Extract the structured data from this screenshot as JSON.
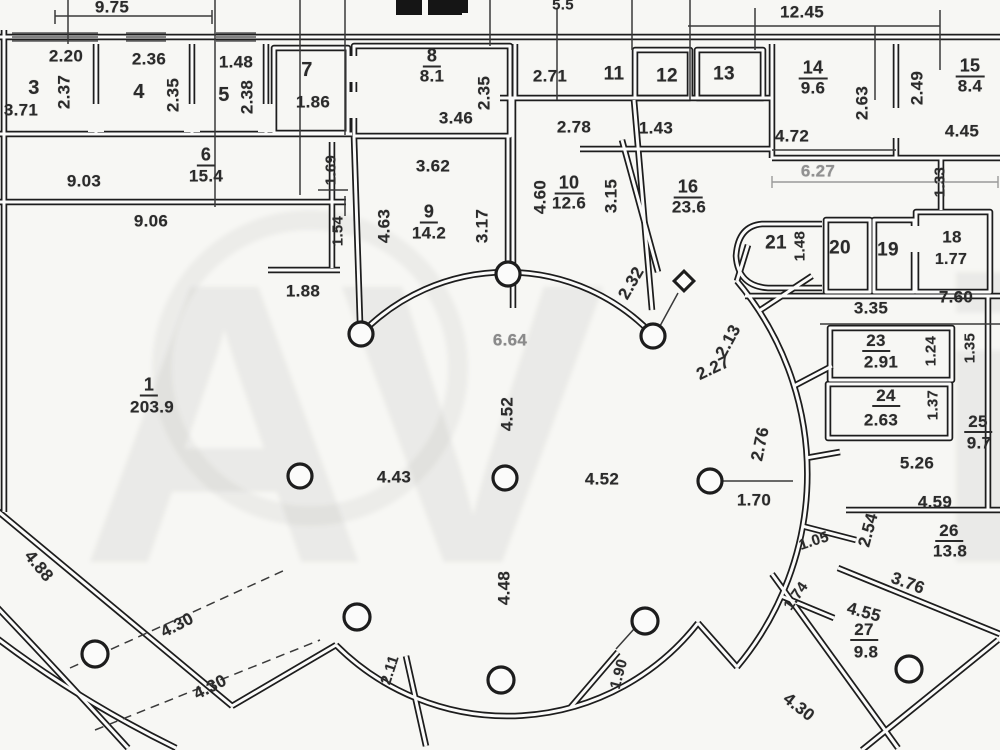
{
  "page": {
    "bg": "#f7f7f4",
    "ink": "#2b2b2b",
    "faded_ink": "#8d8d8d",
    "kind": "scanned floor plan"
  },
  "watermark": {
    "main": "AV",
    "tail": "i"
  },
  "rooms": [
    {
      "number": "1",
      "area": "203.9"
    },
    {
      "number": "3"
    },
    {
      "number": "4"
    },
    {
      "number": "5"
    },
    {
      "number": "6",
      "area": "15.4"
    },
    {
      "number": "7"
    },
    {
      "number": "8",
      "area": "8.1"
    },
    {
      "number": "9",
      "area": "14.2"
    },
    {
      "number": "10",
      "area": "12.6"
    },
    {
      "number": "11"
    },
    {
      "number": "12"
    },
    {
      "number": "13"
    },
    {
      "number": "14",
      "area": "9.6"
    },
    {
      "number": "15",
      "area": "8.4"
    },
    {
      "number": "16",
      "area": "23.6"
    },
    {
      "number": "18",
      "area": "1.77"
    },
    {
      "number": "19"
    },
    {
      "number": "20"
    },
    {
      "number": "21"
    },
    {
      "number": "23",
      "area": "2.91"
    },
    {
      "number": "24",
      "area": "2.63"
    },
    {
      "number": "25",
      "area": "9.7"
    },
    {
      "number": "26",
      "area": "13.8"
    },
    {
      "number": "27",
      "area": "9.8"
    }
  ],
  "plan": {
    "labels": [
      {
        "t": "9.75",
        "x": 112,
        "y": 7
      },
      {
        "t": "5.5",
        "x": 563,
        "y": 5,
        "s": 15
      },
      {
        "t": "12.45",
        "x": 802,
        "y": 12
      },
      {
        "t": "2.20",
        "x": 66,
        "y": 56
      },
      {
        "t": "3",
        "x": 34,
        "y": 88,
        "s": 20
      },
      {
        "t": "2.37",
        "x": 64,
        "y": 92,
        "r": -90
      },
      {
        "t": "3.71",
        "x": 21,
        "y": 110
      },
      {
        "t": "2.36",
        "x": 149,
        "y": 59
      },
      {
        "t": "4",
        "x": 139,
        "y": 92,
        "s": 20
      },
      {
        "t": "2.35",
        "x": 173,
        "y": 95,
        "r": -90
      },
      {
        "t": "1.48",
        "x": 236,
        "y": 62
      },
      {
        "t": "5",
        "x": 224,
        "y": 95,
        "s": 20
      },
      {
        "t": "2.38",
        "x": 247,
        "y": 97,
        "r": -90
      },
      {
        "t": "7",
        "x": 307,
        "y": 70,
        "s": 20
      },
      {
        "t": "1.86",
        "x": 313,
        "y": 102
      },
      {
        "t": "8",
        "x": 432,
        "y": 57,
        "u": 1,
        "s": 18
      },
      {
        "t": "8.1",
        "x": 432,
        "y": 76
      },
      {
        "t": "3.46",
        "x": 456,
        "y": 118
      },
      {
        "t": "2.35",
        "x": 484,
        "y": 93,
        "r": -90
      },
      {
        "t": "2.71",
        "x": 550,
        "y": 76
      },
      {
        "t": "11",
        "x": 614,
        "y": 74,
        "s": 19
      },
      {
        "t": "12",
        "x": 667,
        "y": 76,
        "s": 19
      },
      {
        "t": "13",
        "x": 724,
        "y": 74,
        "s": 19
      },
      {
        "t": "14",
        "x": 813,
        "y": 69,
        "u": 1,
        "s": 18
      },
      {
        "t": "9.6",
        "x": 813,
        "y": 88
      },
      {
        "t": "2.63",
        "x": 862,
        "y": 103,
        "r": -90
      },
      {
        "t": "4.72",
        "x": 792,
        "y": 136
      },
      {
        "t": "2.49",
        "x": 917,
        "y": 88,
        "r": -90
      },
      {
        "t": "15",
        "x": 970,
        "y": 67,
        "u": 1,
        "s": 18
      },
      {
        "t": "8.4",
        "x": 970,
        "y": 86
      },
      {
        "t": "4.45",
        "x": 962,
        "y": 131
      },
      {
        "t": "2.78",
        "x": 574,
        "y": 127
      },
      {
        "t": "1.43",
        "x": 656,
        "y": 128
      },
      {
        "t": "6",
        "x": 206,
        "y": 156,
        "u": 1,
        "s": 18
      },
      {
        "t": "15.4",
        "x": 206,
        "y": 176
      },
      {
        "t": "9.03",
        "x": 84,
        "y": 181
      },
      {
        "t": "9.06",
        "x": 151,
        "y": 221
      },
      {
        "t": "1.69",
        "x": 331,
        "y": 170,
        "r": -90,
        "s": 15
      },
      {
        "t": "1.54",
        "x": 338,
        "y": 231,
        "r": -90,
        "s": 15
      },
      {
        "t": "1.88",
        "x": 303,
        "y": 291
      },
      {
        "t": "3.62",
        "x": 433,
        "y": 166
      },
      {
        "t": "4.63",
        "x": 384,
        "y": 226,
        "r": -90
      },
      {
        "t": "9",
        "x": 429,
        "y": 213,
        "u": 1,
        "s": 18
      },
      {
        "t": "14.2",
        "x": 429,
        "y": 233
      },
      {
        "t": "3.17",
        "x": 482,
        "y": 226,
        "r": -90
      },
      {
        "t": "4.60",
        "x": 540,
        "y": 197,
        "r": -90
      },
      {
        "t": "10",
        "x": 569,
        "y": 184,
        "u": 1,
        "s": 18
      },
      {
        "t": "12.6",
        "x": 569,
        "y": 203
      },
      {
        "t": "3.15",
        "x": 611,
        "y": 196,
        "r": -90
      },
      {
        "t": "16",
        "x": 688,
        "y": 188,
        "u": 1,
        "s": 18
      },
      {
        "t": "23.6",
        "x": 689,
        "y": 207
      },
      {
        "t": "6.27",
        "x": 818,
        "y": 171,
        "c": "#919191"
      },
      {
        "t": "1.33",
        "x": 940,
        "y": 182,
        "r": -90,
        "s": 15
      },
      {
        "t": "21",
        "x": 776,
        "y": 243,
        "s": 19
      },
      {
        "t": "1.48",
        "x": 800,
        "y": 246,
        "r": -90,
        "s": 15
      },
      {
        "t": "20",
        "x": 840,
        "y": 248,
        "s": 19
      },
      {
        "t": "19",
        "x": 888,
        "y": 250,
        "s": 19
      },
      {
        "t": "18",
        "x": 952,
        "y": 237,
        "s": 17
      },
      {
        "t": "1.77",
        "x": 951,
        "y": 260,
        "s": 16
      },
      {
        "t": "3.35",
        "x": 871,
        "y": 308
      },
      {
        "t": "7.60",
        "x": 956,
        "y": 297
      },
      {
        "t": "2.32",
        "x": 631,
        "y": 283,
        "r": -60
      },
      {
        "t": "2.13",
        "x": 728,
        "y": 341,
        "r": -62
      },
      {
        "t": "2.27",
        "x": 713,
        "y": 368,
        "r": -25
      },
      {
        "t": "23",
        "x": 876,
        "y": 342,
        "u": 1,
        "s": 17
      },
      {
        "t": "2.91",
        "x": 881,
        "y": 362
      },
      {
        "t": "1.24",
        "x": 931,
        "y": 351,
        "r": -90,
        "s": 15
      },
      {
        "t": "1.35",
        "x": 970,
        "y": 348,
        "r": -90,
        "s": 15
      },
      {
        "t": "24",
        "x": 886,
        "y": 397,
        "u": 1,
        "s": 17
      },
      {
        "t": "2.63",
        "x": 881,
        "y": 420
      },
      {
        "t": "1.37",
        "x": 933,
        "y": 405,
        "r": -90,
        "s": 15
      },
      {
        "t": "25",
        "x": 978,
        "y": 423,
        "u": 1,
        "s": 17
      },
      {
        "t": "9.7",
        "x": 979,
        "y": 443
      },
      {
        "t": "5.26",
        "x": 917,
        "y": 463
      },
      {
        "t": "2.76",
        "x": 760,
        "y": 444,
        "r": -78
      },
      {
        "t": "1.70",
        "x": 754,
        "y": 500
      },
      {
        "t": "4.59",
        "x": 935,
        "y": 502
      },
      {
        "t": "2.54",
        "x": 868,
        "y": 530,
        "r": -75
      },
      {
        "t": "26",
        "x": 949,
        "y": 532,
        "u": 1,
        "s": 17
      },
      {
        "t": "13.8",
        "x": 950,
        "y": 551
      },
      {
        "t": "1.05",
        "x": 814,
        "y": 541,
        "r": -18,
        "s": 15
      },
      {
        "t": "3.76",
        "x": 908,
        "y": 583,
        "r": 20
      },
      {
        "t": "1.74",
        "x": 796,
        "y": 596,
        "r": -55,
        "s": 15
      },
      {
        "t": "4.55",
        "x": 864,
        "y": 612,
        "r": 15
      },
      {
        "t": "27",
        "x": 864,
        "y": 631,
        "u": 1,
        "s": 17
      },
      {
        "t": "9.8",
        "x": 866,
        "y": 652
      },
      {
        "t": "4.30",
        "x": 799,
        "y": 707,
        "r": 38
      },
      {
        "t": "1",
        "x": 149,
        "y": 386,
        "u": 1,
        "s": 18
      },
      {
        "t": "203.9",
        "x": 152,
        "y": 407
      },
      {
        "t": "6.64",
        "x": 510,
        "y": 340,
        "c": "#8a8a8a"
      },
      {
        "t": "4.52",
        "x": 507,
        "y": 414,
        "r": -90
      },
      {
        "t": "4.43",
        "x": 394,
        "y": 477
      },
      {
        "t": "4.52",
        "x": 602,
        "y": 479
      },
      {
        "t": "4.48",
        "x": 504,
        "y": 588,
        "r": -90
      },
      {
        "t": "4.88",
        "x": 39,
        "y": 566,
        "r": 50
      },
      {
        "t": "4.30",
        "x": 177,
        "y": 625,
        "r": -27
      },
      {
        "t": "4.30",
        "x": 210,
        "y": 687,
        "r": -27
      },
      {
        "t": "2.11",
        "x": 390,
        "y": 670,
        "r": -72,
        "s": 15
      },
      {
        "t": "1.90",
        "x": 619,
        "y": 674,
        "r": -75,
        "s": 15
      }
    ]
  }
}
